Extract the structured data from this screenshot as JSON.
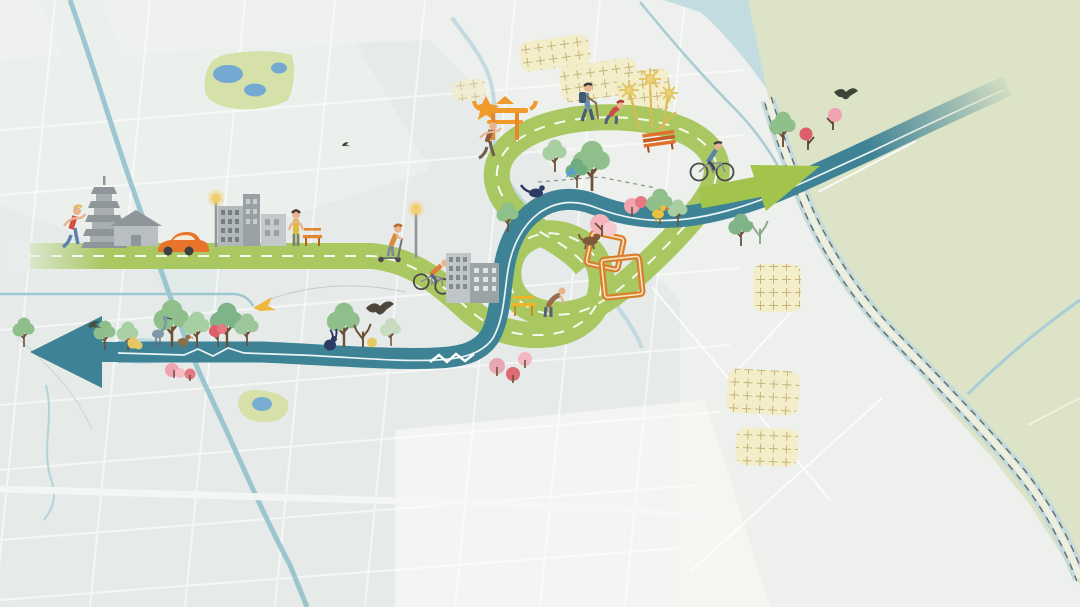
{
  "meta": {
    "title": "Illustrated greenway and blueway route masterplan map",
    "canvas_width": 1080,
    "canvas_height": 607,
    "visible_text": "none"
  },
  "palette": {
    "background": "#edf0ec",
    "city_shade": "#e3eae8",
    "field_green": "#dce3c6",
    "river_blue": "#c3dce1",
    "canal_teal": "#93c2cc",
    "greenway_green": "#a9c862",
    "greenway_arrow_green": "#a2c44c",
    "blueway_teal": "#3e8296",
    "village_yellow": "#f3edca",
    "blossom_pink": "#f0a3b0",
    "accent_orange": "#e8872e",
    "building_gray": "#9aa1a4",
    "lamp_yellow": "#f2cf6e"
  },
  "routes": {
    "greenway": {
      "name": "greenway-road",
      "color": "#a9c862",
      "centerline": "white dashed",
      "shape": "city promenade, downhill bend, loop-the-loop knot, hilltop loop",
      "arrow_direction": "northeast",
      "west_end": "fades into city grid"
    },
    "blueway": {
      "name": "blueway-water-route",
      "color": "#3e8296",
      "centerline": "white wavy line with rapids marks",
      "arrow_direction": "west",
      "northeast_end": "fades into farmland"
    }
  },
  "areas": [
    {
      "name": "city-street-grid",
      "position": "west"
    },
    {
      "name": "farmland-fields",
      "position": "northeast"
    },
    {
      "name": "river",
      "position": "north"
    },
    {
      "name": "levee-road-with-dashed-lines",
      "position": "southeast-boundary"
    },
    {
      "name": "lake-park",
      "x": 248,
      "y": 80
    },
    {
      "name": "pond-park",
      "x": 263,
      "y": 406
    },
    {
      "name": "hatched-village",
      "count": 7
    }
  ],
  "landmarks": [
    {
      "name": "pagoda",
      "x": 104,
      "y": 212
    },
    {
      "name": "farmhouse",
      "x": 136,
      "y": 230
    },
    {
      "name": "orange-car",
      "x": 177,
      "y": 244
    },
    {
      "name": "street-lamp",
      "x": 216,
      "y": 220
    },
    {
      "name": "street-lamp-2",
      "x": 416,
      "y": 235
    },
    {
      "name": "city-buildings",
      "x": 252,
      "y": 220
    },
    {
      "name": "office-towers",
      "x": 472,
      "y": 277
    },
    {
      "name": "paifang-gate",
      "x": 502,
      "y": 115
    },
    {
      "name": "ginkgo-trees",
      "x": 648,
      "y": 102
    },
    {
      "name": "picnic-frames",
      "x": 612,
      "y": 262
    },
    {
      "name": "orange-bench",
      "x": 312,
      "y": 237
    },
    {
      "name": "red-bench",
      "x": 659,
      "y": 138
    },
    {
      "name": "yellow-bench",
      "x": 524,
      "y": 306
    },
    {
      "name": "rapids-mark",
      "x": 455,
      "y": 357
    },
    {
      "name": "rapids-mark-2",
      "x": 228,
      "y": 350
    },
    {
      "name": "blossom-trees",
      "count": 12
    }
  ],
  "figures": [
    {
      "name": "jogger",
      "x": 72,
      "y": 225
    },
    {
      "name": "standing-woman",
      "x": 296,
      "y": 226
    },
    {
      "name": "scooter-girl",
      "x": 390,
      "y": 240
    },
    {
      "name": "downhill-cyclist",
      "x": 432,
      "y": 272
    },
    {
      "name": "loop-runner",
      "x": 488,
      "y": 146
    },
    {
      "name": "backpack-hiker",
      "x": 588,
      "y": 103
    },
    {
      "name": "crouching-child",
      "x": 611,
      "y": 115
    },
    {
      "name": "meadow-cyclist",
      "x": 712,
      "y": 160
    },
    {
      "name": "bench-worker",
      "x": 547,
      "y": 303
    }
  ],
  "wildlife": [
    {
      "name": "heron",
      "x": 158,
      "y": 333
    },
    {
      "name": "brown-duck",
      "x": 183,
      "y": 340
    },
    {
      "name": "navy-rabbit",
      "x": 330,
      "y": 341
    },
    {
      "name": "small-bird",
      "x": 93,
      "y": 326
    },
    {
      "name": "soaring-eagle",
      "x": 378,
      "y": 310
    },
    {
      "name": "yellow-glider-bird",
      "x": 264,
      "y": 305
    },
    {
      "name": "kingfisher",
      "x": 568,
      "y": 171
    },
    {
      "name": "blue-pheasant",
      "x": 536,
      "y": 193
    },
    {
      "name": "yellow-duck",
      "x": 658,
      "y": 212
    },
    {
      "name": "swallow",
      "x": 845,
      "y": 95
    },
    {
      "name": "brown-dog",
      "x": 590,
      "y": 240
    }
  ]
}
